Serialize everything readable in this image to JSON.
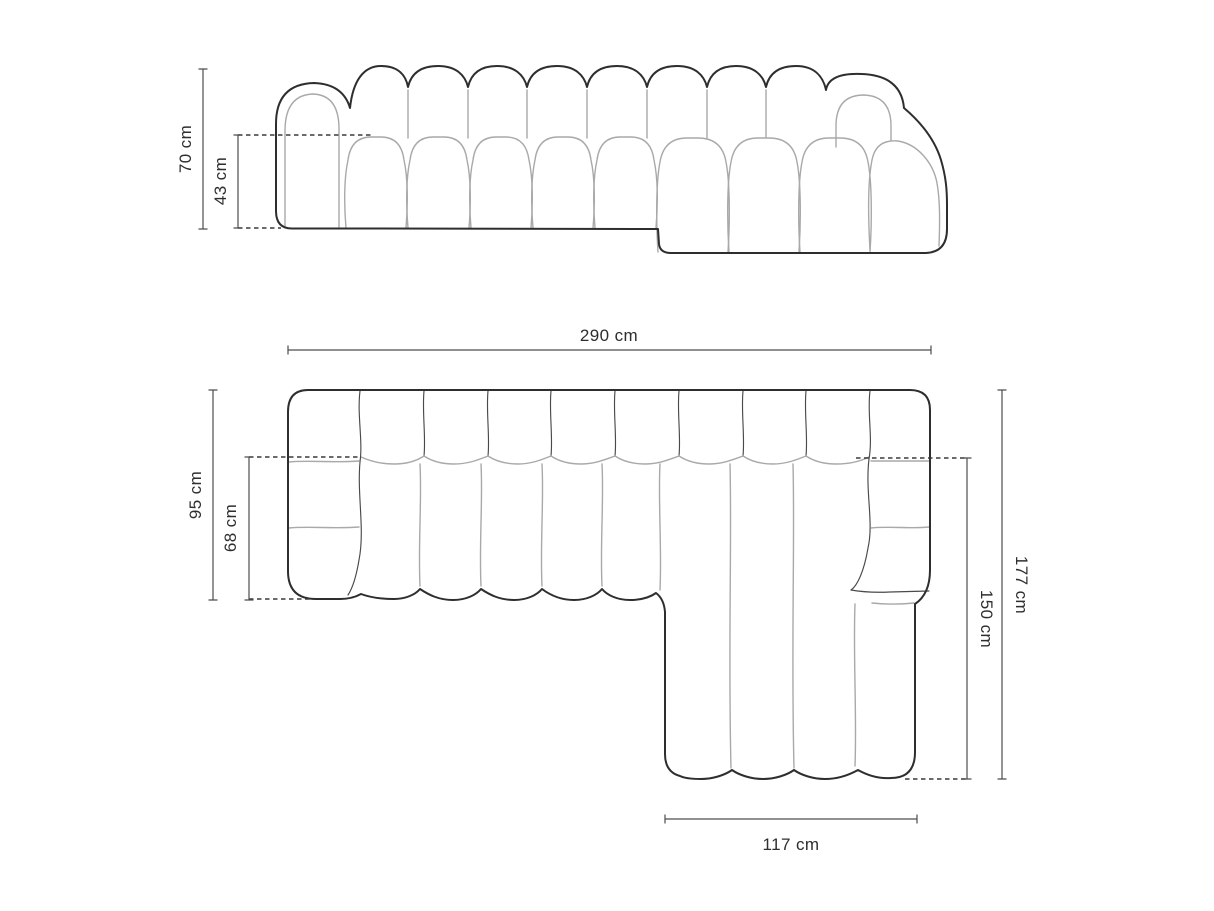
{
  "diagram": {
    "subject": "modular corner sofa with chaise — dimension drawing",
    "front_view": {
      "name": "front elevation",
      "height_total_label": "70 cm",
      "height_seat_label": "43 cm"
    },
    "top_view": {
      "name": "top plan",
      "width_total_label": "290 cm",
      "depth_body_label": "95 cm",
      "depth_seat_label": "68 cm",
      "depth_total_label": "177 cm",
      "depth_chaise_label": "150 cm",
      "width_chaise_label": "117 cm"
    }
  },
  "style": {
    "outline_color": "#2e2e2e",
    "seam_color": "#a9a9a9",
    "divider_color": "#4a4a4a",
    "dimension_color": "#4d4d4d",
    "dash_color": "#3a3a3a",
    "text_color": "#2e2e2e",
    "background_color": "#ffffff"
  }
}
